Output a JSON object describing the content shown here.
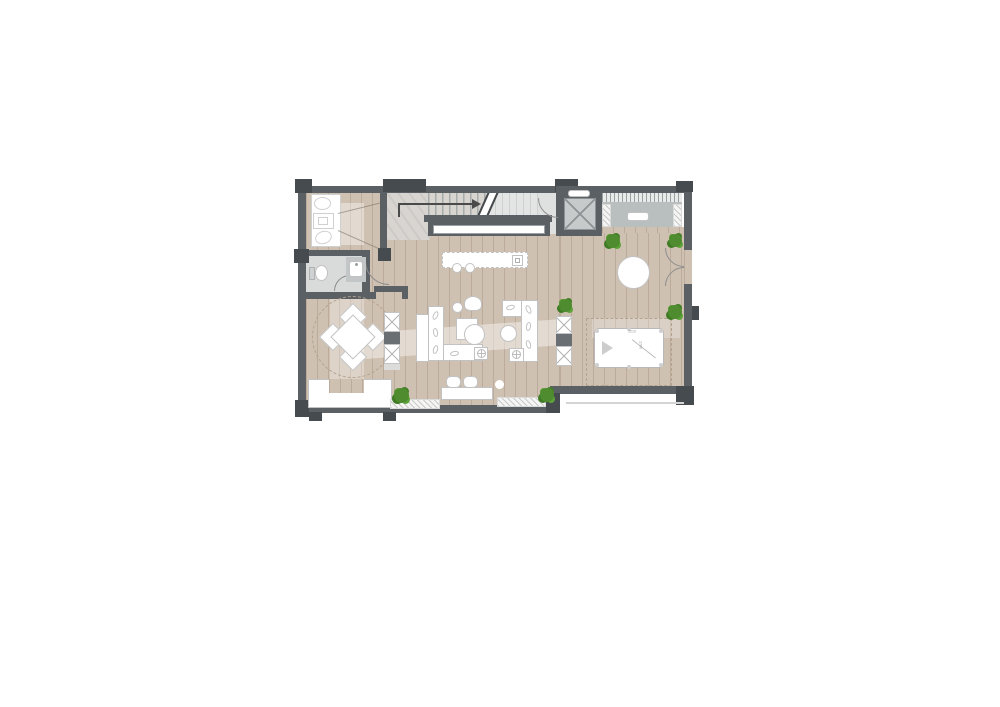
{
  "pool_table": {
    "length_label": "3210",
    "width_label": "1700"
  },
  "colors": {
    "wall": "#5b6064",
    "pier": "#464b4f",
    "wood_floor": "#cfc1b2",
    "plank_line": "#8c735a",
    "tile_floor": "#dfe1e0",
    "marble": "#d8d5d1",
    "furniture_outline": "#c2c2c2",
    "cabinet_gray": "#b9bebe",
    "plant_green": "#4e8c2f"
  }
}
